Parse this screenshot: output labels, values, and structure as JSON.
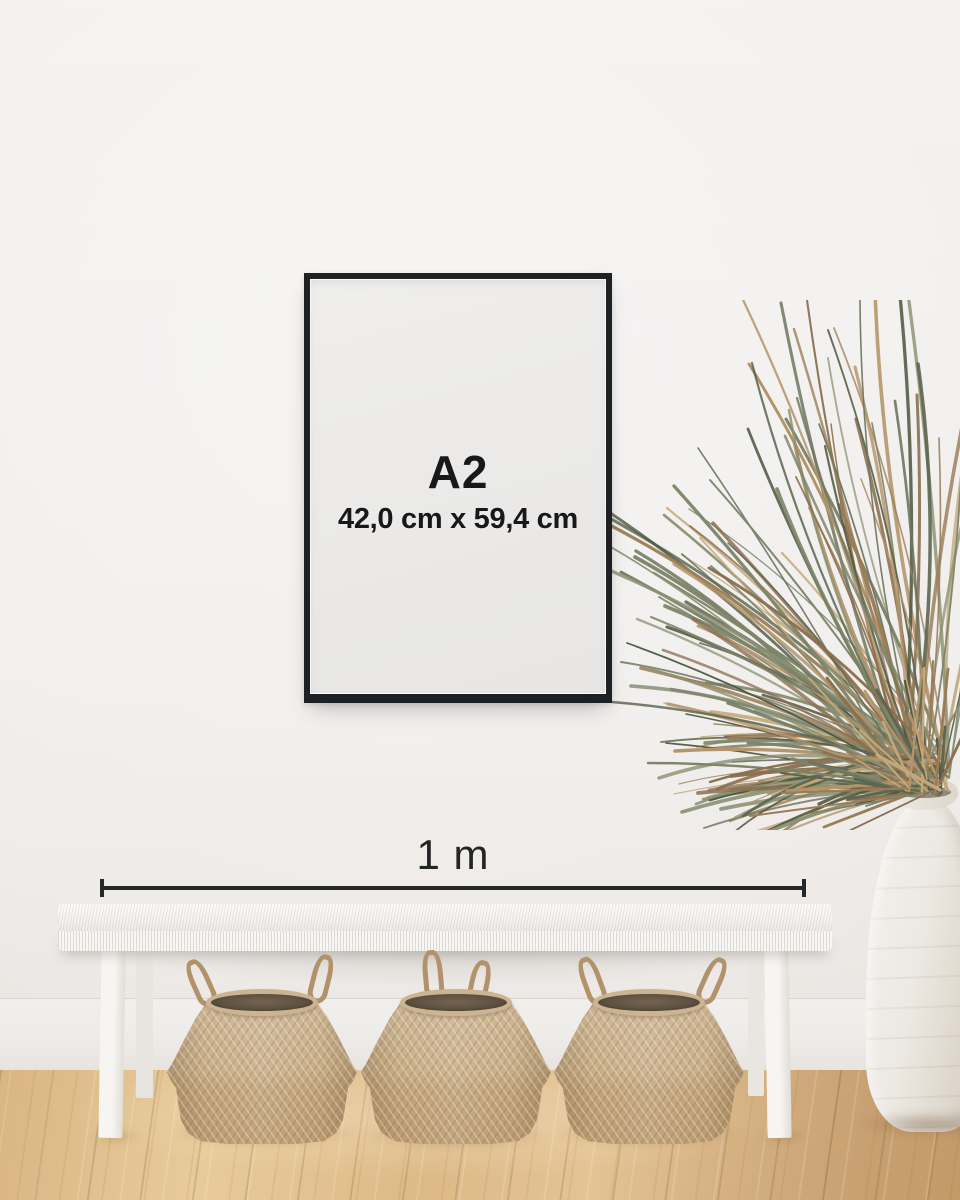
{
  "scene": {
    "wall_top": "#f4f2f0",
    "wall_bottom": "#e9e6e3",
    "floor_light": "#e8cb9a",
    "floor_dark": "#c9a172",
    "baseboard_color": "#efedea"
  },
  "poster": {
    "size_label": "A2",
    "dimensions_label": "42,0 cm x 59,4 cm",
    "frame_color": "#1e2124",
    "paper_color": "#ebeae8",
    "text_color": "#17181a"
  },
  "measurement": {
    "label": "1 m",
    "line_color": "#26282a"
  },
  "decor": {
    "bench_color": "#f6f4f1",
    "basket_count": 3,
    "basket_light": "#cdb695",
    "basket_dark": "#c2a278",
    "basket_interior": "#5e5140",
    "rope_color": "#b1926a",
    "vase_color": "#ece8e2",
    "plant_palette": [
      "#5d6650",
      "#6e765f",
      "#7d8468",
      "#8d9274",
      "#4f5943",
      "#b3946a",
      "#c3a87b",
      "#9a7c57",
      "#8a7050"
    ]
  }
}
